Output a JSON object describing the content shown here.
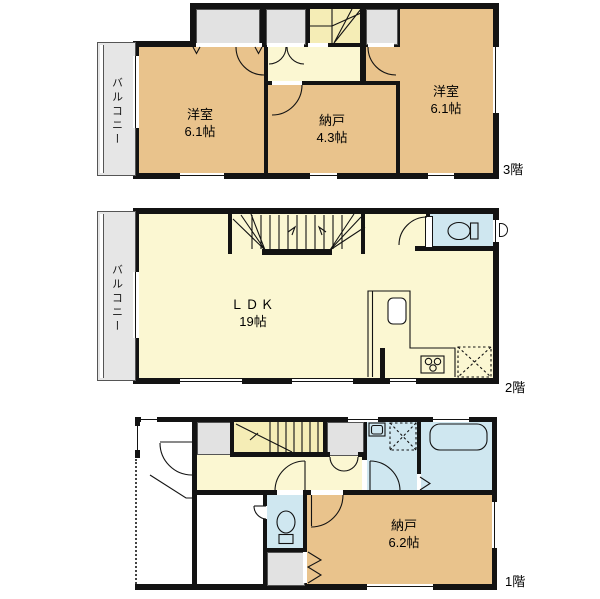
{
  "palette": {
    "wall": "#131313",
    "room_tan": "#e9c38c",
    "room_yellow": "#fbf7d2",
    "stair_yellow": "#f5edb6",
    "wet_blue": "#cfe7f0",
    "closet_gray": "#e2e2e2",
    "balcony_gray": "#e6e6e6"
  },
  "floor3": {
    "label": "3階",
    "balcony": "バルコニー",
    "room_left": {
      "name": "洋室",
      "size": "6.1帖"
    },
    "room_center": {
      "name": "納戸",
      "size": "4.3帖"
    },
    "room_right": {
      "name": "洋室",
      "size": "6.1帖"
    }
  },
  "floor2": {
    "label": "2階",
    "balcony": "バルコニー",
    "ldk": {
      "name": "ＬＤＫ",
      "size": "19帖"
    }
  },
  "floor1": {
    "label": "1階",
    "storage": {
      "name": "納戸",
      "size": "6.2帖"
    }
  },
  "icons": {
    "toilet_2f": "toilet",
    "toilet_1f": "toilet",
    "bathtub_1f": "bathtub",
    "kitchen_sink_2f": "kitchen-sink",
    "stove_2f": "gas-stove",
    "washbasin_1f": "washbasin",
    "washer_space_1f": "washing-machine-space",
    "fridge_space_2f": "refrigerator-space"
  }
}
